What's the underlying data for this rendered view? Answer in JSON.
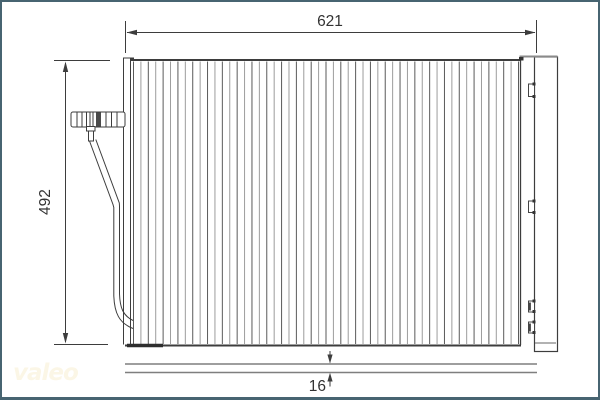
{
  "diagram": {
    "type": "technical-drawing",
    "subject": "condenser-front-and-side-view",
    "dimensions": {
      "width_label": "621",
      "height_label": "492",
      "depth_label": "16"
    },
    "fins": {
      "count": 53
    },
    "logo_text": "valeo",
    "colors": {
      "line": "#3d3d3d",
      "fin_dark": "#5a5a5a",
      "fin_light": "#9c9c9c",
      "gray_line": "#7f7f7f",
      "frame": "#476471",
      "text": "#333333",
      "logo": "#fbf6e6"
    }
  }
}
